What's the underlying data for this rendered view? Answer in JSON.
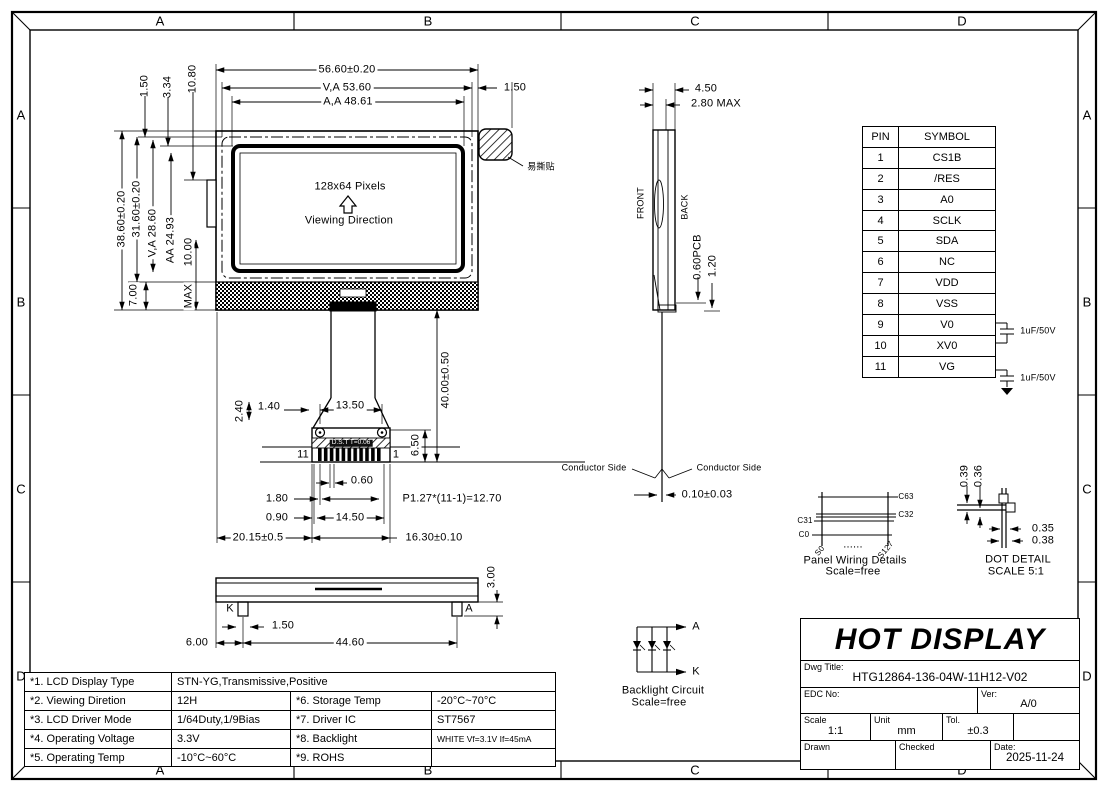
{
  "zones": {
    "cols": [
      "A",
      "B",
      "C",
      "D"
    ],
    "rows": [
      "A",
      "B",
      "C",
      "D"
    ]
  },
  "front_view": {
    "pixels": "128x64 Pixels",
    "viewing": "Viewing Direction",
    "sticker": "易撕贴",
    "dim_overall_w": "56.60±0.20",
    "dim_va_w": "V,A 53.60",
    "dim_aa_w": "A,A 48.61",
    "dim_right": "1.50",
    "dim_top1": "1.50",
    "dim_top2": "3.34",
    "dim_top3": "10.80",
    "dim_overall_h": "38.60±0.20",
    "dim_h2": "31.60±0.20",
    "dim_va_h": "V,A 28.60",
    "dim_aa_h": "AA 24.93",
    "dim_10": "10.00",
    "dim_max": "MAX",
    "dim_7": "7.00"
  },
  "connector": {
    "dim_2_40": "2.40",
    "dim_1_40": "1.40",
    "dim_13_50": "13.50",
    "dim_6_50": "6.50",
    "dim_40": "40.00±0.50",
    "pin_left": "11",
    "pin_right": "1",
    "strip": "D.S.T T=0.06",
    "dim_0_60": "0.60",
    "dim_1_80": "1.80",
    "pitch": "P1.27*(11-1)=12.70",
    "dim_0_90": "0.90",
    "dim_14_50": "14.50",
    "dim_20_15": "20.15±0.5",
    "dim_16_30": "16.30±0.10"
  },
  "bottom_view": {
    "k": "K",
    "a": "A",
    "dim_1_50": "1.50",
    "dim_6": "6.00",
    "dim_44_60": "44.60",
    "dim_3": "3.00"
  },
  "side_view": {
    "dim_4_50": "4.50",
    "dim_2_80": "2.80 MAX",
    "front": "FRONT",
    "back": "BACK",
    "dim_pcb": "0.60PCB",
    "dim_1_20": "1.20",
    "conductor_left": "Conductor Side",
    "conductor_right": "Conductor Side",
    "dim_0_10": "0.10±0.03"
  },
  "pin_table": {
    "headers": [
      "PIN",
      "SYMBOL"
    ],
    "rows": [
      [
        "1",
        "CS1B"
      ],
      [
        "2",
        "/RES"
      ],
      [
        "3",
        "A0"
      ],
      [
        "4",
        "SCLK"
      ],
      [
        "5",
        "SDA"
      ],
      [
        "6",
        "NC"
      ],
      [
        "7",
        "VDD"
      ],
      [
        "8",
        "VSS"
      ],
      [
        "9",
        "V0"
      ],
      [
        "10",
        "XV0"
      ],
      [
        "11",
        "VG"
      ]
    ],
    "cap1": "1uF/50V",
    "cap2": "1uF/50V"
  },
  "panel_wiring": {
    "c63": "C63",
    "c32": "C32",
    "c31": "C31",
    "c0": "C0",
    "s0": "S0",
    "s127": "S127",
    "dots": "......",
    "title": "Panel Wiring Details",
    "scale": "Scale=free"
  },
  "dot_detail": {
    "d39": "0.39",
    "d36": "0.36",
    "d35": "0.35",
    "d38": "0.38",
    "title": "DOT DETAIL",
    "scale": "SCALE 5:1"
  },
  "backlight": {
    "a": "A",
    "k": "K",
    "title": "Backlight Circuit",
    "scale": "Scale=free"
  },
  "spec_table": {
    "rows": [
      [
        "*1. LCD Display Type",
        "STN-YG,Transmissive,Positive",
        "",
        ""
      ],
      [
        "*2. Viewing Diretion",
        "12H",
        "*6. Storage Temp",
        "-20°C~70°C"
      ],
      [
        "*3. LCD Driver Mode",
        "1/64Duty,1/9Bias",
        "*7. Driver IC",
        "ST7567"
      ],
      [
        "*4. Operating Voltage",
        "3.3V",
        "*8. Backlight",
        "WHITE Vf=3.1V If=45mA"
      ],
      [
        "*5. Operating Temp",
        "-10°C~60°C",
        "*9. ROHS",
        ""
      ]
    ]
  },
  "title_block": {
    "company": "HOT DISPLAY",
    "dwg_title_label": "Dwg Title:",
    "dwg_title": "HTG12864-136-04W-11H12-V02",
    "edc_label": "EDC No:",
    "ver_label": "Ver:",
    "ver": "A/0",
    "scale_label": "Scale",
    "scale": "1:1",
    "unit_label": "Unit",
    "unit": "mm",
    "tol_label": "Tol.",
    "tol": "±0.3",
    "drawn_label": "Drawn",
    "checked_label": "Checked",
    "date_label": "Date:",
    "date": "2025-11-24"
  }
}
